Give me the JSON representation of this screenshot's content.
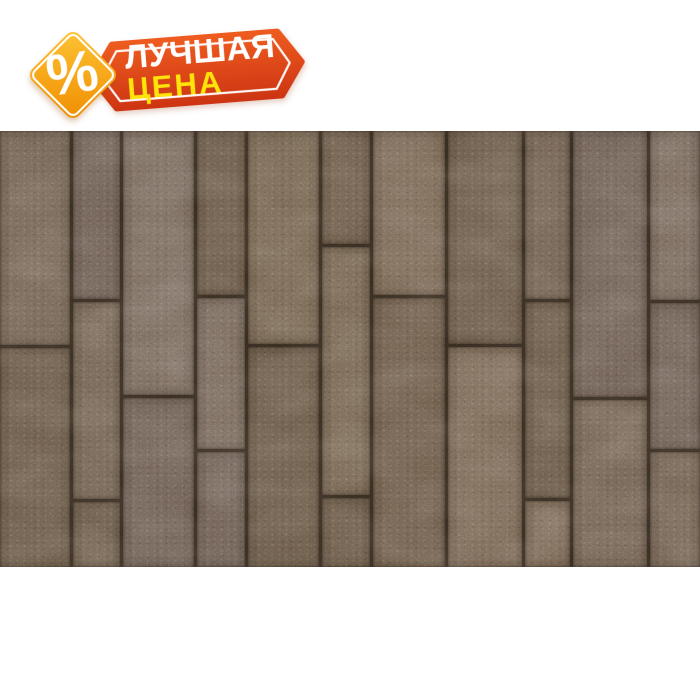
{
  "page": {
    "width": 700,
    "height": 700,
    "background": "#ffffff"
  },
  "badge": {
    "line1": "ЛУЧШАЯ",
    "line2": "ЦЕНА",
    "percent": "%",
    "colors": {
      "ribbon_top": "#ee5b1f",
      "ribbon_bottom": "#ce3613",
      "line1_text": "#ffffff",
      "line2_text": "#ffe30a",
      "diamond_light": "#fcc434",
      "diamond_dark": "#f08d00",
      "outline": "#ffffff"
    }
  },
  "photo": {
    "alt": "Brown rectangular paving planks of mixed widths laid vertically in a staggered running-bond pattern",
    "left": 0,
    "top": 131,
    "width": 700,
    "height": 436,
    "gap": 3,
    "seam_color": "#32281e",
    "palette": [
      "#6e5f51",
      "#695949",
      "#73655a",
      "#675848",
      "#70614f",
      "#6b5d54",
      "#756454",
      "#665747"
    ],
    "columns": [
      {
        "x": 0,
        "w": 73,
        "joints": [
          348
        ]
      },
      {
        "x": 73,
        "w": 50,
        "joints": [
          302,
          502
        ]
      },
      {
        "x": 123,
        "w": 74,
        "joints": [
          398
        ]
      },
      {
        "x": 197,
        "w": 51,
        "joints": [
          298,
          452
        ]
      },
      {
        "x": 248,
        "w": 74,
        "joints": [
          347
        ]
      },
      {
        "x": 322,
        "w": 51,
        "joints": [
          247,
          498
        ]
      },
      {
        "x": 373,
        "w": 75,
        "joints": [
          298
        ]
      },
      {
        "x": 448,
        "w": 77,
        "joints": [
          347
        ]
      },
      {
        "x": 525,
        "w": 48,
        "joints": [
          302,
          501
        ]
      },
      {
        "x": 573,
        "w": 77,
        "joints": [
          400
        ]
      },
      {
        "x": 650,
        "w": 50,
        "joints": [
          303,
          452
        ]
      }
    ]
  }
}
